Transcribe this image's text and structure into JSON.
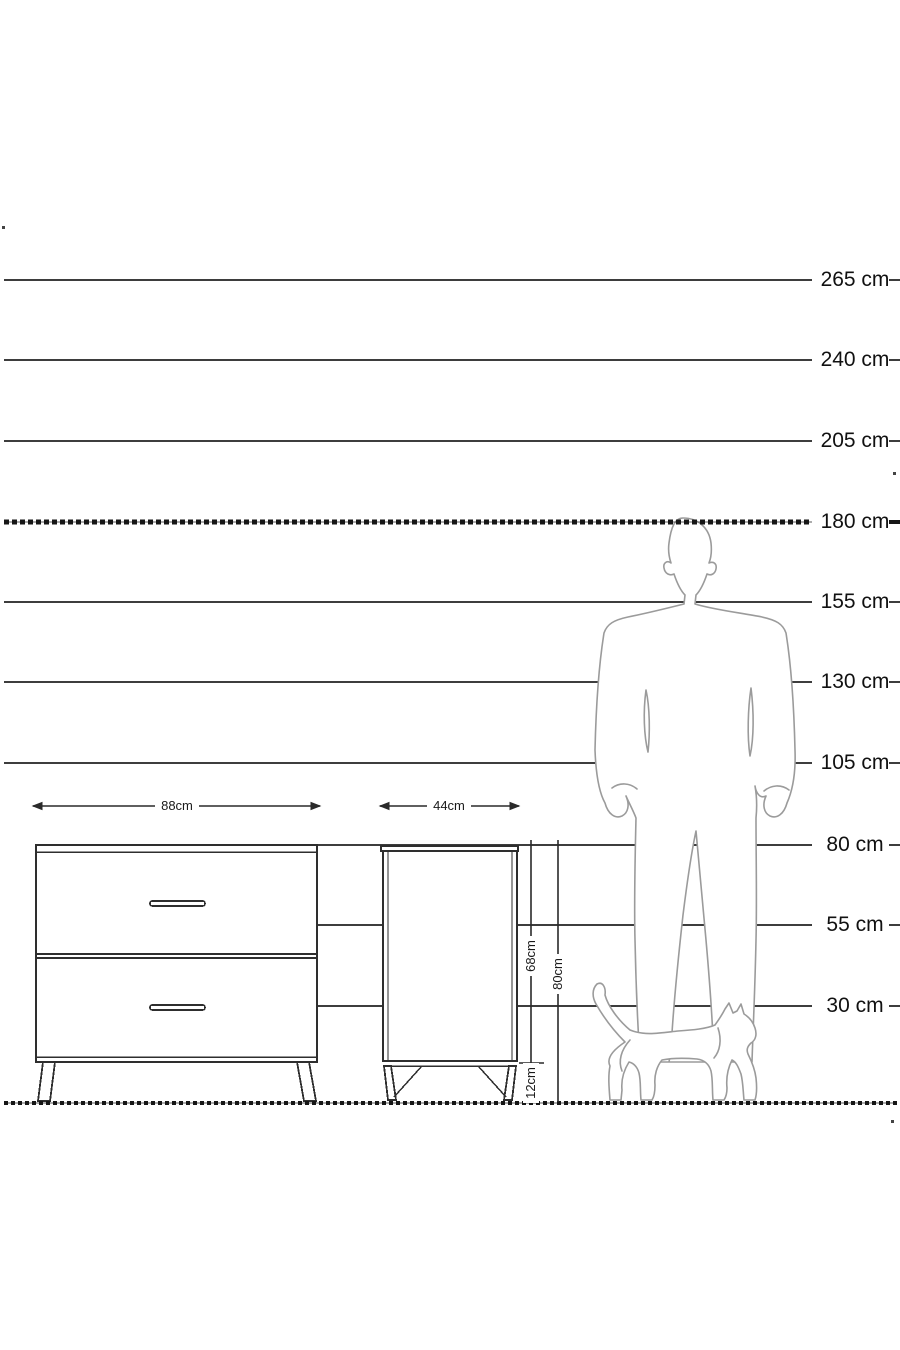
{
  "diagram": {
    "type": "furniture-dimension-diagram",
    "unit": "cm",
    "height_scale": {
      "labels": [
        "265 cm",
        "240 cm",
        "205 cm",
        "180 cm",
        "155 cm",
        "130 cm",
        "105 cm",
        "80 cm",
        "55 cm",
        "30 cm"
      ],
      "values_cm": [
        265,
        240,
        205,
        180,
        155,
        130,
        105,
        80,
        55,
        30
      ],
      "emphasized_label": "180 cm"
    },
    "furniture": {
      "dresser": {
        "width_label": "88cm",
        "drawer_count": 2
      },
      "nightstand": {
        "width_label": "44cm",
        "body_height_label": "68cm",
        "total_height_label": "80cm",
        "leg_height_label": "12cm"
      }
    },
    "silhouettes": [
      {
        "name": "man"
      },
      {
        "name": "cat"
      }
    ],
    "colors": {
      "line": "#3d3d3d",
      "emphasis_line": "#161616",
      "silhouette_outline": "#9b9b9b",
      "text": "#111111",
      "background": "#ffffff"
    }
  }
}
